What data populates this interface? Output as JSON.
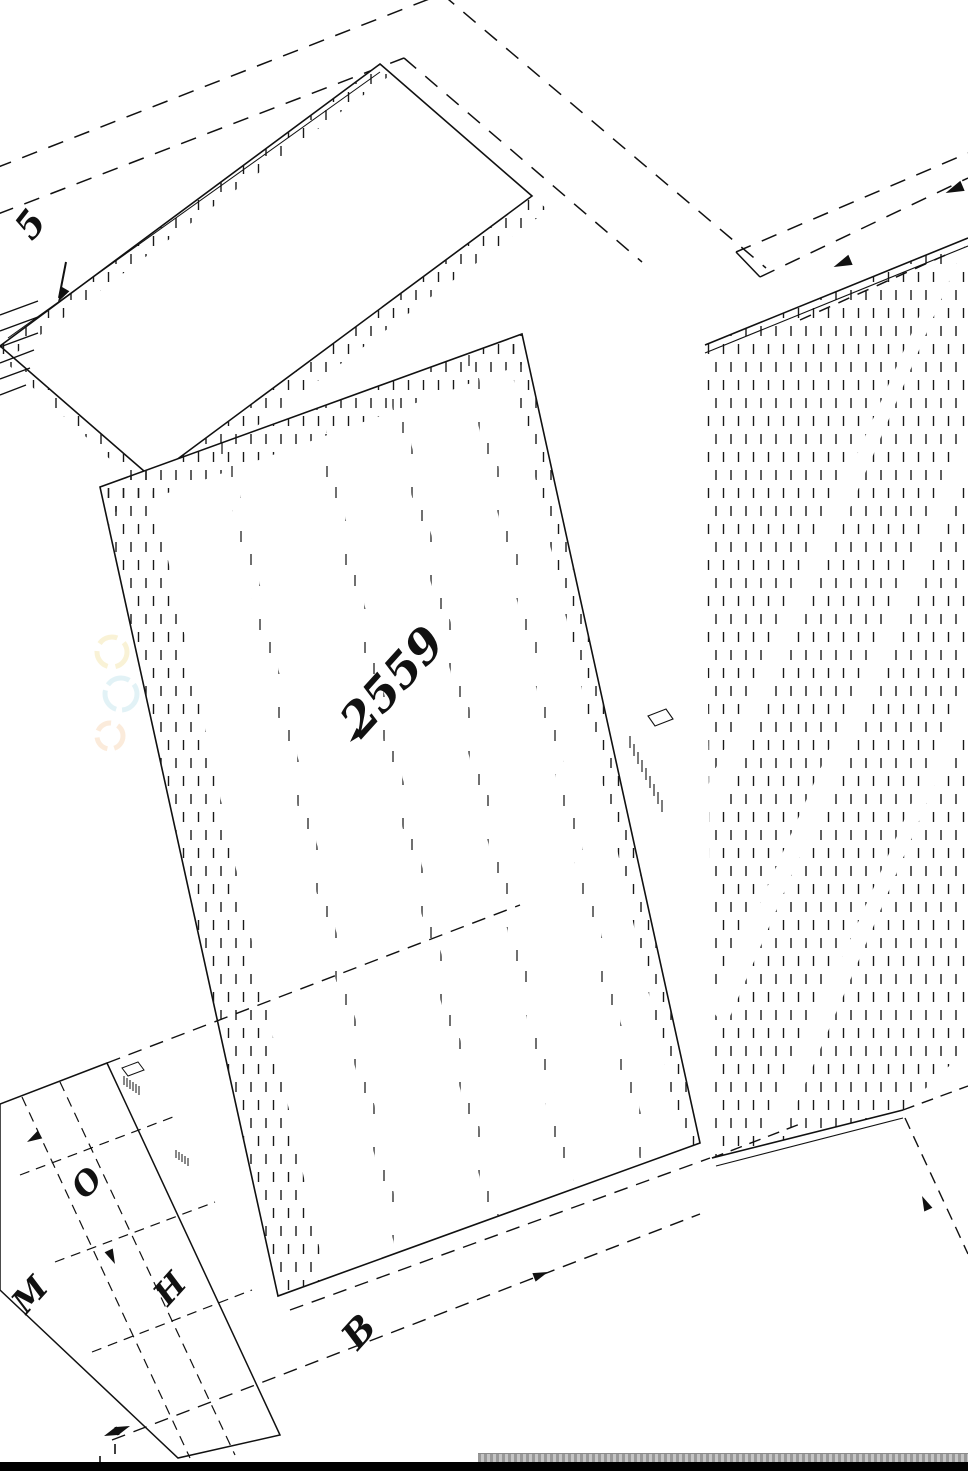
{
  "drawing": {
    "title_hint": "isometric exploded furniture CAD drawing",
    "labels": {
      "part_marker": "5",
      "main_dimension": "2559",
      "dim_o": "O",
      "dim_m": "M",
      "dim_h": "H",
      "dim_b": "B"
    },
    "colors": {
      "line": "#111111",
      "background": "#ffffff",
      "hatch": "#1a1a1a",
      "statusbar": "#000000",
      "scrollbar_track": "#b7b7b7",
      "watermark_yellow": "#e8c84a",
      "watermark_blue": "#7ec8d8",
      "watermark_orange": "#f0a860"
    }
  }
}
